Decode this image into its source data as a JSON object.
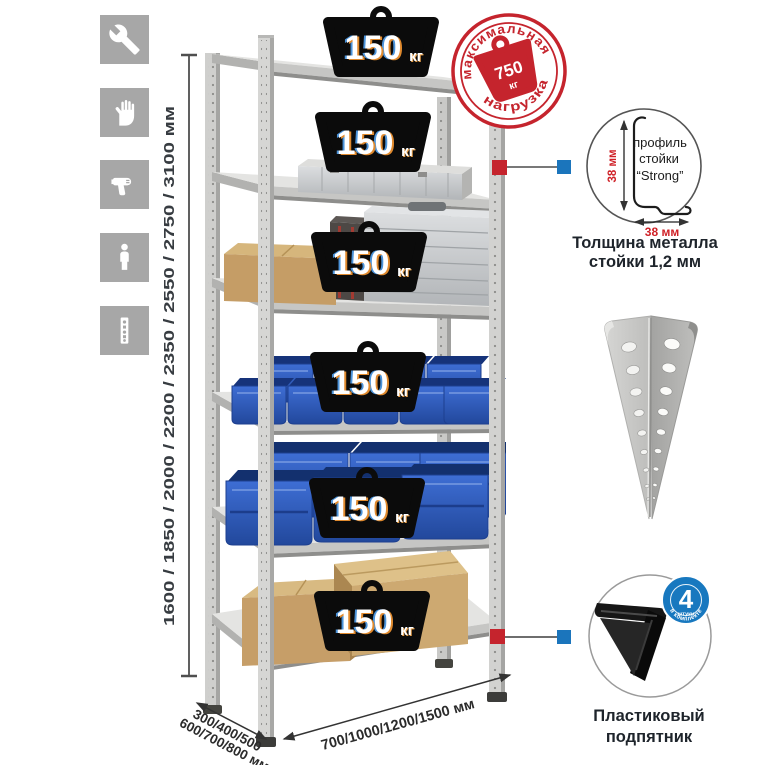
{
  "left_toolbar": {
    "icons": [
      "wrench-icon",
      "work-gloves-icon",
      "drill-icon",
      "person-icon",
      "rack-post-icon"
    ]
  },
  "dimensions": {
    "height_label": "1600 / 1850 / 2000 / 2200 / 2350 / 2550 / 2750 / 3100 мм",
    "depth_label_line1": "300/400/500",
    "depth_label_line2": "600/700/800 мм",
    "width_label": "700/1000/1200/1500 мм"
  },
  "rack": {
    "shelf_count": 6,
    "shelf_load_value": "150",
    "shelf_load_unit": "кг"
  },
  "stamp": {
    "arc_top": "максимальная",
    "arc_bottom": "нагрузка",
    "value": "750",
    "unit": "кг"
  },
  "profile_detail": {
    "label_line1": "профиль",
    "label_line2": "стойки",
    "label_line3": "“Strong”",
    "dim_vertical": "38 мм",
    "dim_horizontal": "38 мм",
    "caption_line1": "Толщина металла",
    "caption_line2": "стойки 1,2 мм"
  },
  "foot_detail": {
    "badge_value": "4",
    "badge_unit": "штуки",
    "badge_arc": "в комплекте",
    "caption_line1": "Пластиковый",
    "caption_line2": "подпятник"
  },
  "colors": {
    "accent_red": "#c5242d",
    "accent_blue": "#1b75bc",
    "bin_blue": "#2b5cb8",
    "metal_gray": "#d2d2d0"
  }
}
